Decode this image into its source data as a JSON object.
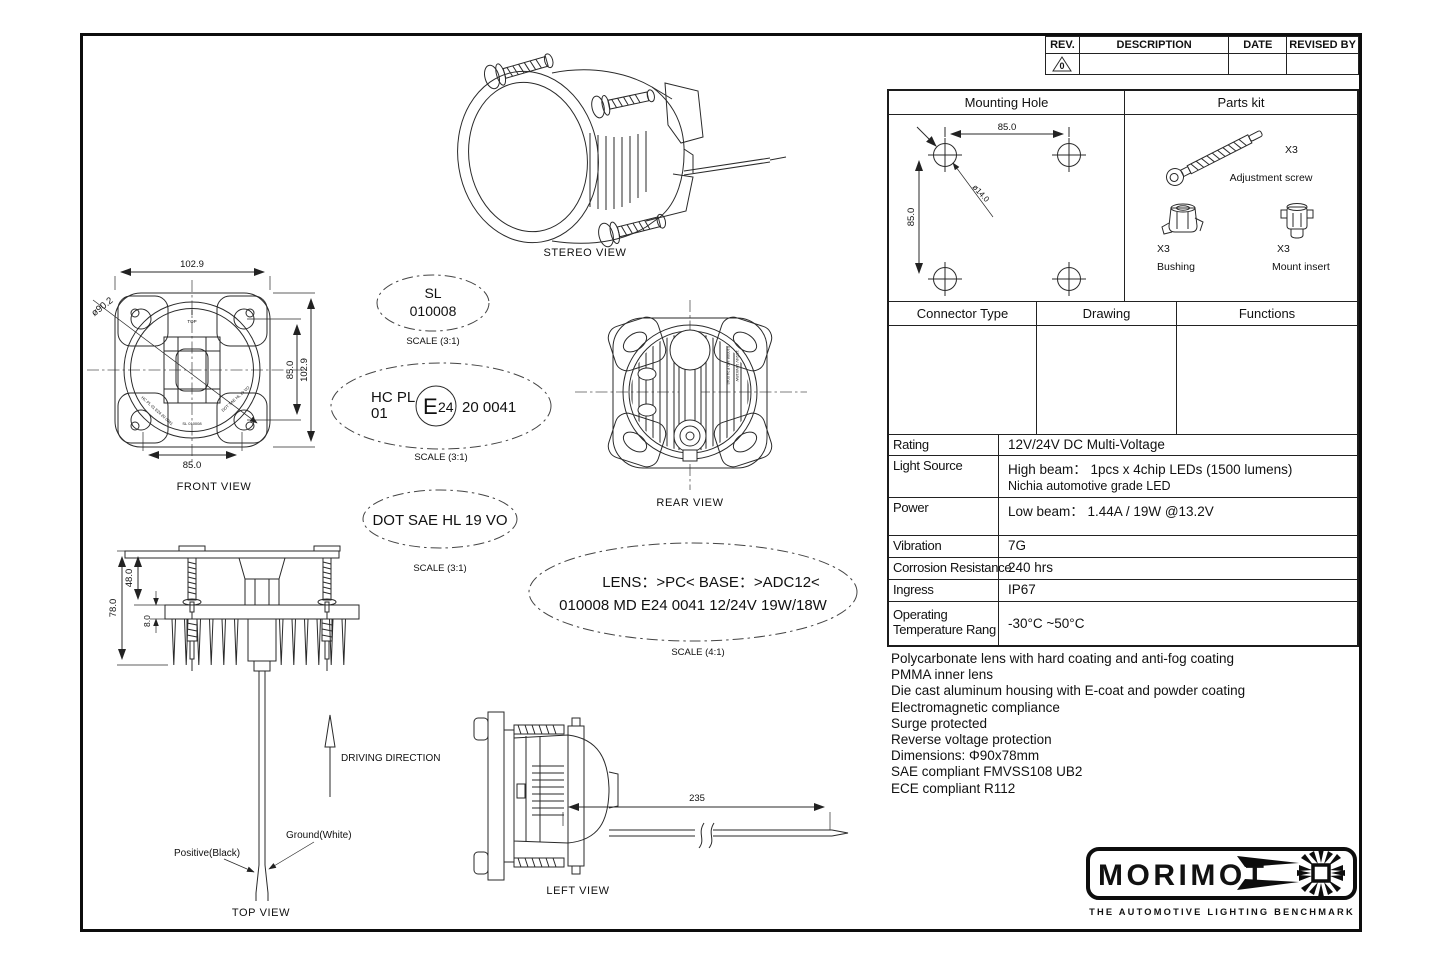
{
  "revision": {
    "col_rev": "REV.",
    "col_description": "DESCRIPTION",
    "col_date": "DATE",
    "col_revised": "REVISED BY",
    "rev_mark": "0"
  },
  "parts_panel": {
    "mounting_hole_title": "Mounting Hole",
    "parts_kit_title": "Parts kit",
    "dim_h": "85.0",
    "dim_v": "85.0",
    "dim_dia": "ø14.0",
    "adjustment_screw_qty": "X3",
    "adjustment_screw_label": "Adjustment screw",
    "bushing_qty": "X3",
    "bushing_label": "Bushing",
    "mount_insert_qty": "X3",
    "mount_insert_label": "Mount insert"
  },
  "connector_panel": {
    "col1": "Connector Type",
    "col2": "Drawing",
    "col3": "Functions"
  },
  "specs": {
    "rows": [
      {
        "label": "Rating",
        "value": "12V/24V DC Multi-Voltage"
      },
      {
        "label": "Light Source",
        "value": "High beam： 1pcs x 4chip LEDs (1500 lumens)",
        "value2": "Nichia automotive grade LED"
      },
      {
        "label": "Power",
        "value": "Low beam： 1.44A / 19W @13.2V"
      },
      {
        "label": "Vibration",
        "value": "7G"
      },
      {
        "label": "Corrosion Resistance",
        "value": "240 hrs"
      },
      {
        "label": "Ingress",
        "value": "IP67"
      },
      {
        "label": "Operating Temperature Rang",
        "value": "-30°C ~50°C"
      }
    ]
  },
  "notes": [
    "Polycarbonate lens with hard coating and anti-fog coating",
    "PMMA inner lens",
    "Die cast aluminum housing with E-coat and powder coating",
    "Electromagnetic compliance",
    "Surge protected",
    "Reverse voltage protection",
    "Dimensions: Φ90x78mm",
    "SAE compliant FMVSS108 UB2",
    "ECE compliant R112"
  ],
  "logo": {
    "brand": "MORIMOT",
    "tagline": "THE AUTOMOTIVE LIGHTING BENCHMARK"
  },
  "views": {
    "stereo": "STEREO VIEW",
    "front": "FRONT VIEW",
    "rear": "REAR VIEW",
    "top": "TOP VIEW",
    "left": "LEFT VIEW"
  },
  "badges": {
    "sl": {
      "line1": "SL",
      "line2": "010008",
      "scale": "SCALE (3:1)"
    },
    "hc": {
      "left_top": "HC PL",
      "left_bottom": "01",
      "e_big": "E",
      "e_small": "24",
      "right": "20 0041",
      "scale": "SCALE (3:1)"
    },
    "dot": {
      "text": "DOT SAE HL 19 VO",
      "scale": "SCALE (3:1)"
    },
    "lens": {
      "line1": "LENS：>PC<  BASE：>ADC12<",
      "line2": "010008   MD E24 0041   12/24V  19W/18W",
      "scale": "SCALE (4:1)"
    }
  },
  "front_dims": {
    "top_width": "102.9",
    "bottom_width": "85.0",
    "dia": "ø90.2",
    "right_inner": "85.0",
    "right_outer": "102.9",
    "top_mark": "TOP",
    "etch_left": "HC PL 01 E24 20 0041",
    "etch_center": "SL 010008",
    "etch_right": "DOT SAE HL 19 VO"
  },
  "top_dims": {
    "total": "78.0",
    "upper": "48.0",
    "flange": "8.0",
    "positive": "Positive(Black)",
    "ground": "Ground(White)",
    "driving": "DRIVING DIRECTION"
  },
  "left_dims": {
    "wire": "235"
  },
  "rear_etch": {
    "line1": "010008  MD E24 0041",
    "line2": "12/24V  19W/18W"
  }
}
